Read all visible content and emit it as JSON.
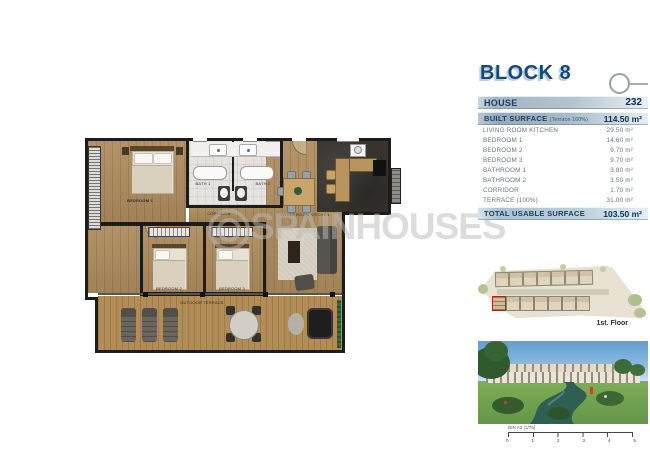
{
  "panel": {
    "block_title": "BLOCK 8",
    "house": {
      "label": "HOUSE",
      "value": "232"
    },
    "built": {
      "label": "BUILT SURFACE",
      "sub": "(Terrace 100%)",
      "value": "114.50 m²"
    },
    "rows": [
      {
        "label": "LIVING ROOM KITCHEN",
        "value": "29.50 m²"
      },
      {
        "label": "BEDROOM 1",
        "value": "14.60 m²"
      },
      {
        "label": "BEDROOM 2",
        "value": "9.70 m²"
      },
      {
        "label": "BEDROOM 3",
        "value": "9.70 m²"
      },
      {
        "label": "BATHROOM 1",
        "value": "3.80 m²"
      },
      {
        "label": "BATHROOM 2",
        "value": "3.50 m²"
      },
      {
        "label": "CORRIDOR",
        "value": "1.70 m²"
      },
      {
        "label": "TERRACE (100%)",
        "value": "31.00 m²"
      }
    ],
    "total": {
      "label": "TOTAL USABLE SURFACE",
      "value": "103.50 m²"
    },
    "floor_label": "1st. Floor",
    "scale": {
      "label": "DIN A3 (1/75)",
      "ticks": [
        "0",
        "1",
        "2",
        "3",
        "4",
        "5"
      ]
    }
  },
  "plan": {
    "watermark": "SPAINHOUSES",
    "rooms": {
      "bedroom1": "BEDROOM 1",
      "bath1": "BATH 1",
      "bath2": "BATH 2",
      "corridor": "CORRIDOR",
      "living": "LIVING ROOM KITCHEN",
      "bedroom2": "BEDROOM 2",
      "bedroom3": "BEDROOM 3",
      "terrace": "OUTDOOR TERRACE"
    }
  },
  "colors": {
    "accent_navy": "#17487a",
    "bar_steel": "#a4b6c2",
    "wood": "#ae8d5f",
    "wall": "#1c1c1c",
    "highlight_red": "#a52a18",
    "watermark_gray": "#b9b9b9"
  }
}
